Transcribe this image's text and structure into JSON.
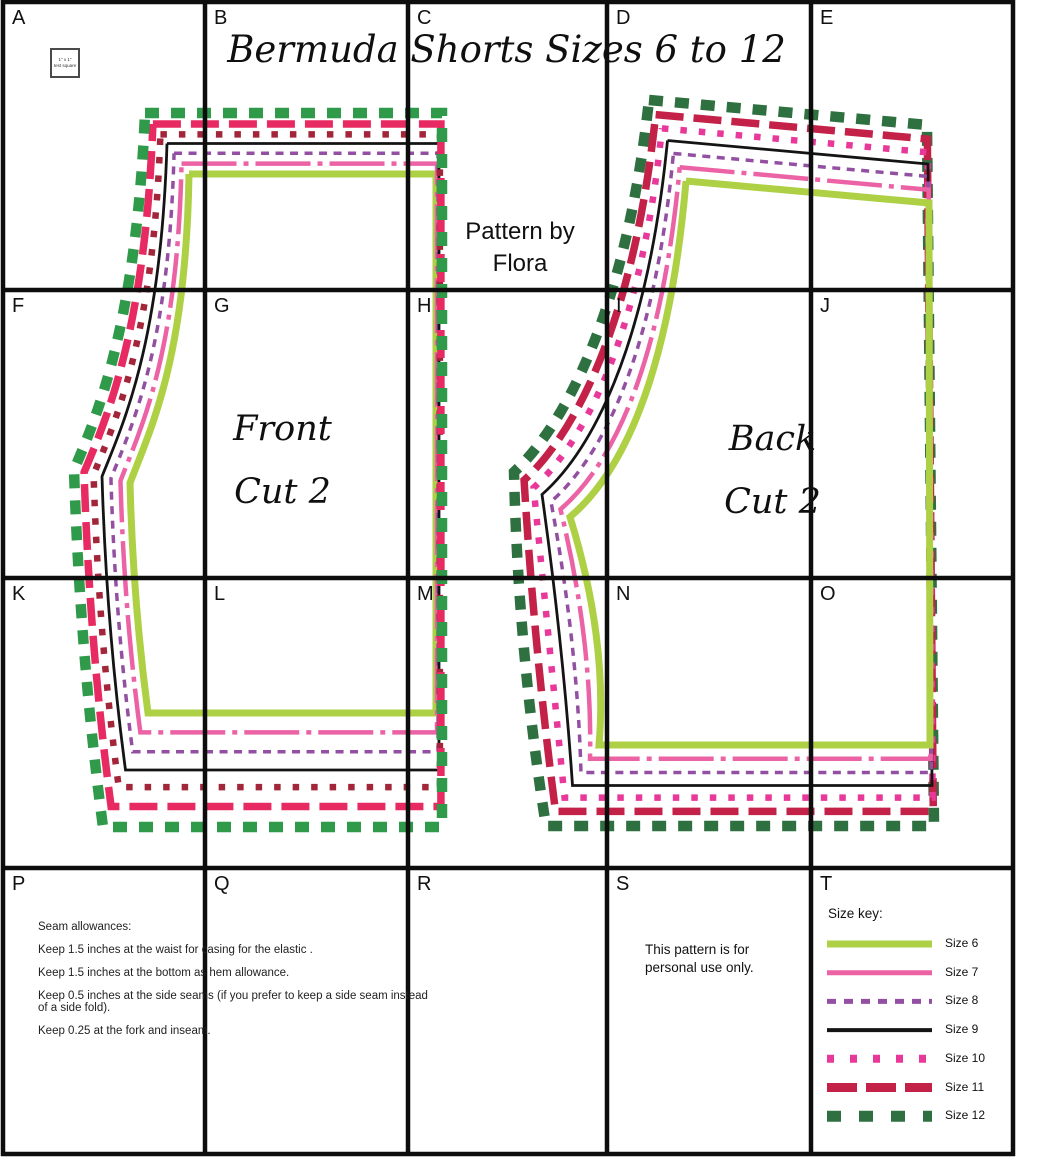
{
  "title": "Bermuda Shorts Sizes 6 to 12",
  "byline": {
    "line1": "Pattern by",
    "line2": "Flora"
  },
  "test_square": {
    "line1": "1\" x 1\"",
    "line2": "test square"
  },
  "grid": {
    "tile_labels": [
      "A",
      "B",
      "C",
      "D",
      "E",
      "F",
      "G",
      "H",
      "I",
      "J",
      "K",
      "L",
      "M",
      "N",
      "O",
      "P",
      "Q",
      "R",
      "S",
      "T"
    ],
    "col_lines": [
      3,
      205,
      408,
      607,
      811,
      1013
    ],
    "row_lines": [
      2,
      290,
      578,
      868,
      1154
    ],
    "line_color": "#0d0d0d",
    "line_width": 4.5
  },
  "sizes": [
    {
      "id": "6",
      "label": "Size 6",
      "t": 0.0,
      "color": "#aed044",
      "width": 7,
      "dash": "",
      "key_width": 7,
      "key_dash": ""
    },
    {
      "id": "7",
      "label": "Size 7",
      "t": 0.17,
      "color": "#ec63a5",
      "width": 4.5,
      "dash": "55 7 5 7",
      "key_width": 5,
      "key_dash": ""
    },
    {
      "id": "8",
      "label": "Size 8",
      "t": 0.34,
      "color": "#9350a2",
      "width": 3.5,
      "dash": "8 6.5",
      "key_width": 5,
      "key_dash": "9 8"
    },
    {
      "id": "9",
      "label": "Size 9",
      "t": 0.5,
      "color": "#141414",
      "width": 2.8,
      "dash": "",
      "key_width": 4,
      "key_dash": ""
    },
    {
      "id": "10",
      "label": "Size 10",
      "t": 0.65,
      "color": "#e8399a",
      "width": 6.5,
      "dash": "6.5 12",
      "key_width": 8,
      "key_dash": "7 16"
    },
    {
      "id": "11",
      "label": "Size 11",
      "t": 0.82,
      "color": "#c32148",
      "width": 7.5,
      "dash": "28 10",
      "key_width": 9,
      "key_dash": "30 9"
    },
    {
      "id": "12",
      "label": "Size 12",
      "t": 1.0,
      "color": "#2e7040",
      "width": 10.5,
      "dash": "14 12",
      "key_width": 11,
      "key_dash": "14 18"
    }
  ],
  "pieces": [
    {
      "name": "front",
      "label_line1": "Front",
      "label_line2": "Cut 2",
      "draw_order": [
        "6",
        "7",
        "8",
        "9",
        "10",
        "11",
        "12"
      ],
      "color_overrides": {
        "10": "#a22539",
        "11": "#e82a62",
        "12": "#2f9a4a"
      },
      "geometry": {
        "inner": {
          "waist_left": [
            189,
            174
          ],
          "waist_right": [
            436,
            174
          ],
          "fold_bottom": [
            436,
            713
          ],
          "hem_left": [
            148,
            713
          ],
          "inseam_ctrl": [
            133,
            600
          ],
          "crotch": [
            130,
            483
          ],
          "rise_c1": [
            150,
            430
          ],
          "rise_c2": [
            186,
            360
          ]
        },
        "outer": {
          "waist_left": [
            145,
            113
          ],
          "waist_right": [
            442,
            113
          ],
          "fold_bottom": [
            442,
            827
          ],
          "hem_left": [
            103,
            827
          ],
          "inseam_ctrl": [
            80,
            655
          ],
          "crotch": [
            74,
            470
          ],
          "rise_c1": [
            95,
            420
          ],
          "rise_c2": [
            136,
            330
          ]
        }
      }
    },
    {
      "name": "back",
      "label_line1": "Back",
      "label_line2": "Cut 2",
      "draw_order": [
        "12",
        "11",
        "10",
        "9",
        "8",
        "7",
        "6"
      ],
      "color_overrides": {},
      "geometry": {
        "inner": {
          "waist_left": [
            686,
            181
          ],
          "waist_right": [
            929,
            203
          ],
          "fold_bottom": [
            930,
            745
          ],
          "hem_left": [
            599,
            745
          ],
          "inseam_ctrl": [
            608,
            640
          ],
          "crotch": [
            570,
            517
          ],
          "rise_c1": [
            616,
            478
          ],
          "rise_c2": [
            668,
            390
          ]
        },
        "outer": {
          "waist_left": [
            649,
            100
          ],
          "waist_right": [
            927,
            125
          ],
          "fold_bottom": [
            934,
            826
          ],
          "hem_left": [
            546,
            826
          ],
          "inseam_ctrl": [
            518,
            650
          ],
          "crotch": [
            514,
            472
          ],
          "rise_c1": [
            560,
            430
          ],
          "rise_c2": [
            625,
            320
          ]
        }
      }
    }
  ],
  "size_key": {
    "heading": "Size key:",
    "swatch_x1": 827,
    "swatch_x2": 932,
    "label_x": 945,
    "first_row_y": 944,
    "row_gap": 28.7
  },
  "notes": {
    "heading": "Seam allowances:",
    "lines": [
      "Keep 1.5 inches at the waist for casing for the elastic .",
      "Keep 1.5 inches at the bottom as hem allowance.",
      "Keep 0.5 inches at the side seams (if you prefer to keep a side seam instead of a side fold).",
      "Keep 0.25 at the fork and inseam."
    ]
  },
  "usage_note": {
    "line1": "This pattern is for",
    "line2": "personal use only."
  }
}
